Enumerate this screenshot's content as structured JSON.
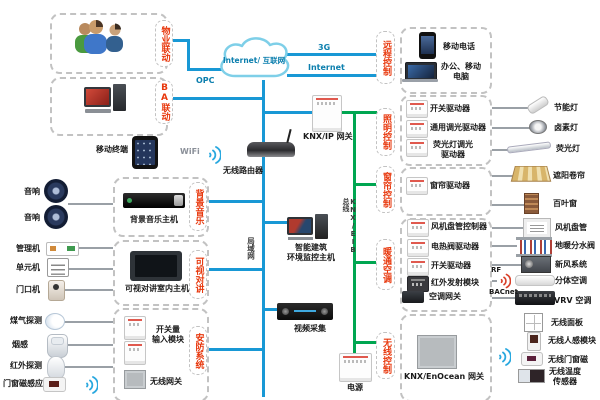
{
  "colors": {
    "lan_blue": "#1898d5",
    "knx_green": "#00a651",
    "pill_red": "#e8380d"
  },
  "cloud": {
    "label": "Internet/ 互联网"
  },
  "net_labels": {
    "g3": "3G",
    "internet": "Internet",
    "opc": "OPC",
    "wifi": "WiFi",
    "lan": "局域网",
    "knx_bus": "KNX/EIB 总线",
    "rf": "RF",
    "bacnet": "BACnet"
  },
  "center": {
    "mobile_terminal": "移动终端",
    "router": "无线路由器",
    "knx_ip_gateway": "KNX/IP 网关",
    "monitor_host": "智能建筑\n环境监控主机",
    "video_capture": "视频采集",
    "power": "电源"
  },
  "groups": {
    "property": {
      "pill": "物业联动"
    },
    "ba": {
      "pill": "BA联动"
    },
    "remote": {
      "pill": "远程控制",
      "items": [
        "移动电话",
        "办公、移动\n电脑"
      ]
    },
    "lighting": {
      "pill": "照明控制",
      "actuators": [
        "开关驱动器",
        "通用调光驱动器",
        "荧光灯调光\n驱动器"
      ],
      "loads": [
        "节能灯",
        "卤素灯",
        "荧光灯"
      ]
    },
    "curtain": {
      "pill": "窗帘控制",
      "actuators": [
        "窗帘驱动器"
      ],
      "loads": [
        "遮阳卷帘",
        "百叶窗"
      ]
    },
    "hvac": {
      "pill": "暖通空调",
      "actuators": [
        "风机盘管控制器",
        "电热阀驱动器",
        "开关驱动器",
        "红外发射模块",
        "空调网关"
      ],
      "loads": [
        "风机盘管",
        "地暖分水阀",
        "新风系统",
        "分体空调",
        "VRV 空调"
      ]
    },
    "wireless": {
      "pill": "无线控制",
      "gateway": "KNX/EnOcean 网关",
      "devices": [
        "无线面板",
        "无线人感模块",
        "无线门窗磁",
        "无线温度\n传感器"
      ]
    },
    "bgm": {
      "pill": "背景音乐",
      "host": "背景音乐主机",
      "speakers": [
        "音响",
        "音响"
      ]
    },
    "intercom": {
      "pill": "可视对讲",
      "host": "可视对讲室内主机",
      "stations": [
        "管理机",
        "单元机",
        "门口机"
      ]
    },
    "security": {
      "pill": "安防系统",
      "module": "开关量\n输入模块",
      "gateway": "无线网关",
      "sensors": [
        "煤气探测",
        "烟感",
        "红外探测",
        "门窗磁感应"
      ]
    }
  }
}
